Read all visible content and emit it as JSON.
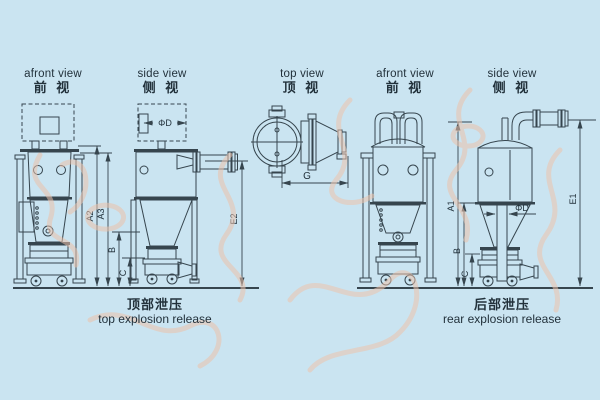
{
  "canvas": {
    "background_color": "#cae4f1",
    "line_color": "#36454e",
    "text_color": "#22313b",
    "watermark_color": "#ecc2ab"
  },
  "view_headers": [
    {
      "en": "afront view",
      "zh": "前 视"
    },
    {
      "en": "side view",
      "zh": "侧 视"
    },
    {
      "en": "top view",
      "zh": "顶 视"
    },
    {
      "en": "afront view",
      "zh": "前 视"
    },
    {
      "en": "side view",
      "zh": "侧 视"
    }
  ],
  "captions": {
    "top_release": {
      "zh": "顶部泄压",
      "en": "top explosion release"
    },
    "rear_release": {
      "zh": "后部泄压",
      "en": "rear explosion release"
    }
  },
  "dimension_labels": {
    "a2": "A2",
    "a3": "A3",
    "b_left": "B",
    "c_left": "C",
    "e2": "E2",
    "phi_d_left": "ΦD",
    "g": "G",
    "a1": "A1",
    "b_right": "B",
    "c_right": "C",
    "e1": "E1",
    "phi_d_right": "ΦD"
  }
}
